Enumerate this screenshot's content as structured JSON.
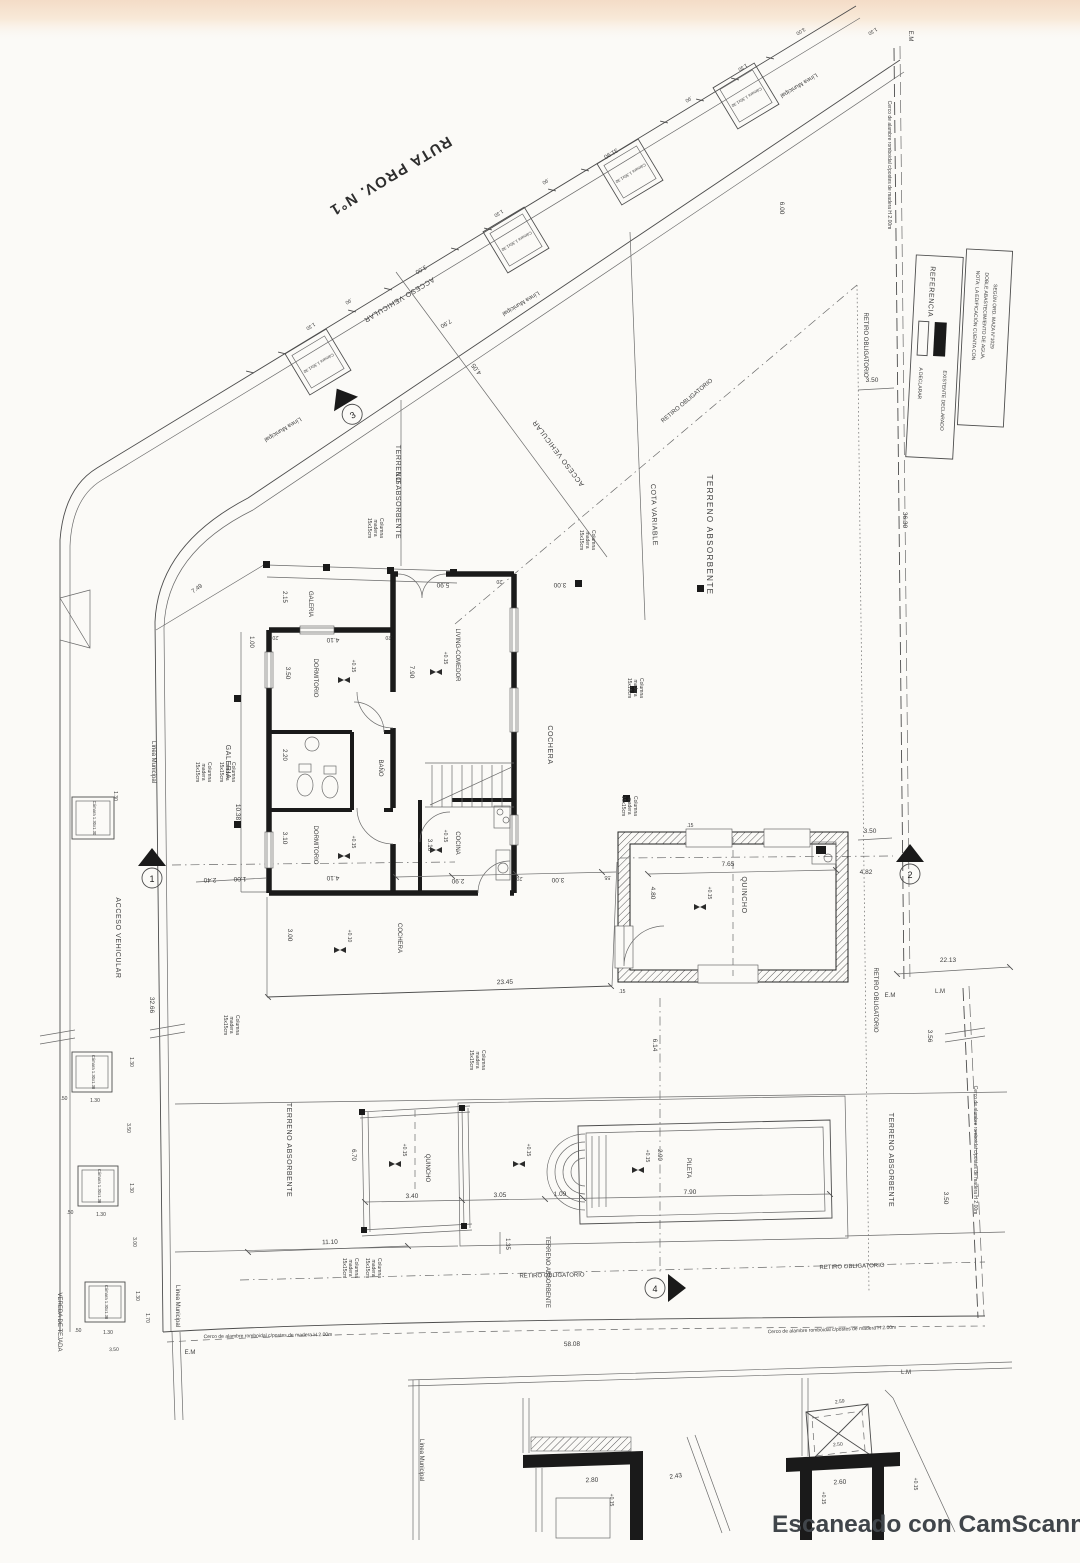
{
  "page": {
    "watermark": "Escaneado con CamScanner"
  },
  "site": {
    "road": "RUTA PROV. N°1",
    "municipal": "Línea Municipal",
    "access": "ACCESO VEHICULAR",
    "cota": "COTA VARIABLE",
    "terreno": "TERRENO ABSORBENTE",
    "retiro": "RETIRO OBLIGATORIO",
    "fence": "Cerco de alambre romboidal c/postes de madera H 2.00m",
    "sidewalk": "VEREDA DE TEJADA",
    "em": "E.M",
    "lm": "L.M",
    "chamber": "Cámara 1.30x1.30",
    "col1": "Columna",
    "col2": "madera",
    "col3": "15x15cm"
  },
  "rooms": {
    "galeria": "GALERIA",
    "dormitorio": "DORMITORIO",
    "banio": "BAÑO",
    "cocina": "COCINA",
    "living": "LIVING-COMEDOR",
    "cochera": "COCHERA",
    "quincho": "QUINCHO",
    "pileta": "PILETA"
  },
  "levels": {
    "p015": "+0.15",
    "p010": "+0.10"
  },
  "legend": {
    "title": "REFERENCIA",
    "existing": "EXISTENTE DECLARADO",
    "declare": "A DECLARAR",
    "note1": "NOTA: LA EDIFICACIÓN CUENTA CON",
    "note2": "DOBLE ABASTECIMIENTO DE AGUA,",
    "note3": "SEGÚN ORD. MAZA N°1029"
  },
  "markers": {
    "m1": "1",
    "m2": "2",
    "m3": "3",
    "m4": "4"
  },
  "dims": {
    "v015": ".15",
    "v020": ".20",
    "v050": ".50",
    "v055": ".55",
    "v090": ".90",
    "v100": "1.00",
    "v109": "1.09",
    "v130": "1.30",
    "v135": "1.35",
    "v170": "1.70",
    "v215": "2.15",
    "v220": "2.20",
    "v240": "2.40",
    "v243": "2.43",
    "v250": "2.50",
    "v259": "2.59",
    "v260": "2.60",
    "v280": "2.80",
    "v290": "2.90",
    "v300": "3.00",
    "v305": "3.05",
    "v310": "3.10",
    "v340": "3.40",
    "v350": "3.50",
    "v356": "3.56",
    "v405": "4.05",
    "v410": "4.10",
    "v480": "4.80",
    "v482": "4.82",
    "v590": "5.90",
    "v600": "6.00",
    "v614": "6.14",
    "v615": "6.15",
    "v670": "6.70",
    "v749": "7.49",
    "v765": "7.65",
    "v790": "7.90",
    "v1038": "10.38",
    "v1110": "11.10",
    "v2213": "22.13",
    "v2345": "23.45",
    "v3190": "31.90",
    "v3266": "32.66",
    "v3630": "36.30",
    "v5808": "58.08"
  }
}
